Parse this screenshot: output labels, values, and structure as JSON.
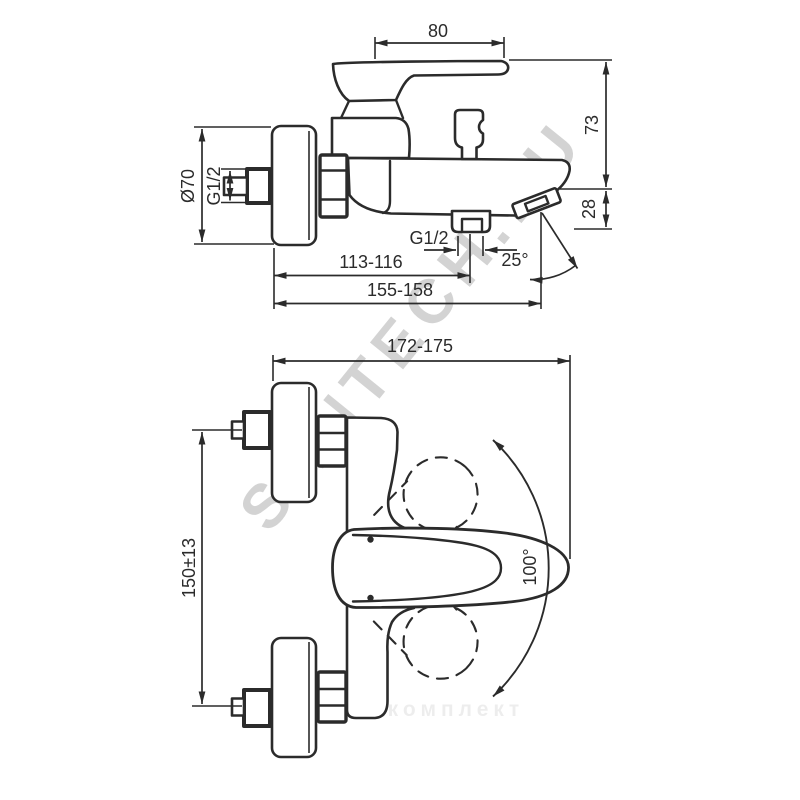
{
  "title": "Bath mixer installation drawing",
  "side_view": {
    "handle_width": "80",
    "body_height": "73",
    "spout_drop": "28",
    "escutcheon_diameter": "Ø70",
    "inlet_thread": "G1/2",
    "shower_outlet_thread": "G1/2",
    "wall_to_outlet": "113-116",
    "wall_to_spout_tip": "155-158",
    "spout_angle": "25°"
  },
  "plan_view": {
    "overall_depth": "172-175",
    "connection_spacing": "150±13",
    "handle_swing": "100°"
  },
  "watermarks": {
    "diagonal": "SANTECH.RU",
    "bottom": "сантехкомплект"
  },
  "colors": {
    "line": "#2b2b2b",
    "background": "#ffffff",
    "watermark": "#bdbdbd"
  }
}
